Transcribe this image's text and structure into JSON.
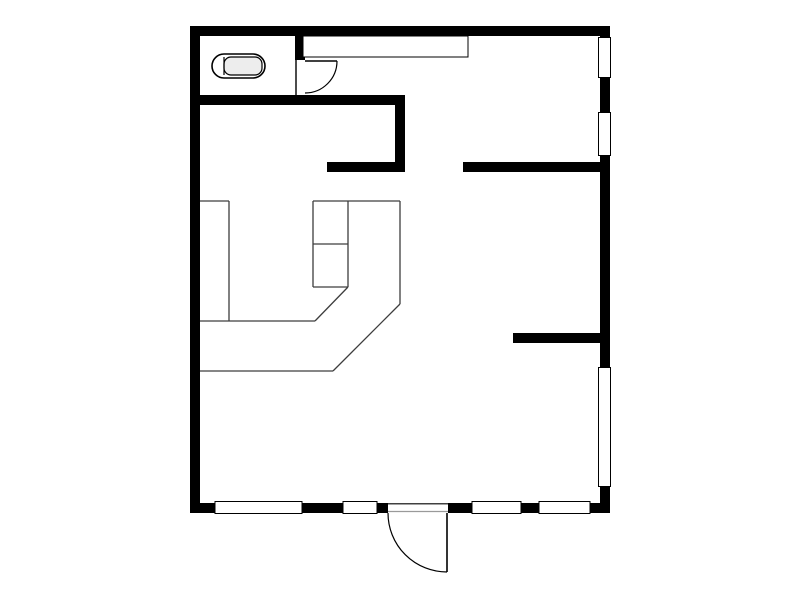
{
  "canvas": {
    "width": 800,
    "height": 600,
    "background": "#ffffff",
    "wall_color": "#000000",
    "outline_color": "#000000",
    "furniture_line_color": "#3d3d3d",
    "threshold_line_color": "#9a9a9a",
    "fixture_fill": "#ededed",
    "window_fill": "#ffffff"
  },
  "plan": {
    "walls": [
      {
        "name": "top-exterior-wall",
        "x": 190,
        "y": 26,
        "w": 420,
        "h": 10
      },
      {
        "name": "left-exterior-wall",
        "x": 190,
        "y": 26,
        "w": 10,
        "h": 487
      },
      {
        "name": "right-exterior-wall",
        "x": 600,
        "y": 26,
        "w": 10,
        "h": 487
      },
      {
        "name": "bottom-exterior-wall",
        "x": 190,
        "y": 503,
        "w": 420,
        "h": 10
      },
      {
        "name": "wc-south-wall",
        "x": 190,
        "y": 95,
        "w": 215,
        "h": 10
      },
      {
        "name": "wc-east-wall",
        "x": 295,
        "y": 36,
        "w": 10,
        "h": 24
      },
      {
        "name": "hall-west-wall",
        "x": 395,
        "y": 105,
        "w": 10,
        "h": 67
      },
      {
        "name": "hall-south-wall",
        "x": 327,
        "y": 162,
        "w": 78,
        "h": 10
      },
      {
        "name": "east-room-north-wall",
        "x": 463,
        "y": 162,
        "w": 147,
        "h": 10
      },
      {
        "name": "east-room-south-wall",
        "x": 513,
        "y": 333,
        "w": 97,
        "h": 10
      }
    ],
    "windows": [
      {
        "name": "window-right-upper",
        "x": 598.5,
        "y": 37.5,
        "w": 12,
        "h": 40
      },
      {
        "name": "window-right-middle",
        "x": 598.5,
        "y": 112.5,
        "w": 12,
        "h": 43
      },
      {
        "name": "window-right-lower",
        "x": 598.5,
        "y": 367.5,
        "w": 12,
        "h": 119
      },
      {
        "name": "window-bottom-1",
        "x": 215,
        "y": 501.5,
        "w": 87,
        "h": 12
      },
      {
        "name": "window-bottom-2",
        "x": 343,
        "y": 501.5,
        "w": 34,
        "h": 12
      },
      {
        "name": "window-bottom-3",
        "x": 472,
        "y": 501.5,
        "w": 49,
        "h": 12
      },
      {
        "name": "window-bottom-4",
        "x": 539,
        "y": 501.5,
        "w": 51,
        "h": 12
      }
    ],
    "doors": [
      {
        "name": "wc-door",
        "jamb": [
          296,
          60,
          296,
          95
        ],
        "leaf": [
          305,
          61,
          337,
          61
        ],
        "arc": "M 337 61 A 32 32 0 0 1 305 93"
      },
      {
        "name": "entry-door",
        "opening": {
          "x": 388,
          "y": 502.5,
          "w": 60,
          "h": 11
        },
        "threshold_top": [
          388,
          503.8,
          448,
          503.8
        ],
        "threshold_bottom": [
          388,
          511.5,
          448,
          511.5
        ],
        "leaf": [
          447,
          513,
          447,
          572
        ],
        "arc": "M 388 513 A 59 59 0 0 0 447 572"
      }
    ],
    "closet": {
      "name": "closet",
      "x": 303,
      "y": 36,
      "w": 165,
      "h": 21
    },
    "counter_lines": [
      {
        "name": "counter-top-edge-left",
        "pts": [
          200,
          201,
          229,
          201
        ]
      },
      {
        "name": "counter-top-edge-right",
        "pts": [
          313,
          201,
          400,
          201
        ]
      },
      {
        "name": "counter-left-unit-side",
        "pts": [
          229,
          201,
          229,
          321
        ]
      },
      {
        "name": "counter-sink-left-side",
        "pts": [
          313,
          201,
          313,
          287
        ]
      },
      {
        "name": "counter-sink-right-side",
        "pts": [
          348,
          201,
          348,
          287
        ]
      },
      {
        "name": "counter-sink-divider",
        "pts": [
          313,
          244,
          348,
          244
        ]
      },
      {
        "name": "counter-sink-bottom",
        "pts": [
          313,
          287,
          348,
          287
        ]
      },
      {
        "name": "counter-inner-bottom-edge",
        "pts": [
          200,
          321,
          315,
          321
        ]
      },
      {
        "name": "counter-inner-diagonal",
        "pts": [
          315,
          321,
          348,
          287
        ]
      },
      {
        "name": "counter-outer-right-edge",
        "pts": [
          400,
          201,
          400,
          304
        ]
      },
      {
        "name": "counter-outer-diagonal",
        "pts": [
          400,
          304,
          333,
          371
        ]
      },
      {
        "name": "counter-outer-bottom-edge",
        "pts": [
          200,
          371,
          333,
          371
        ]
      }
    ],
    "toilet": {
      "bowl": {
        "x": 212,
        "y": 54,
        "w": 53,
        "h": 24,
        "rx": 12
      },
      "tank": {
        "x": 224,
        "y": 57,
        "w": 38,
        "h": 18,
        "rx": 7
      },
      "seam": [
        224,
        57,
        224,
        75
      ]
    }
  }
}
